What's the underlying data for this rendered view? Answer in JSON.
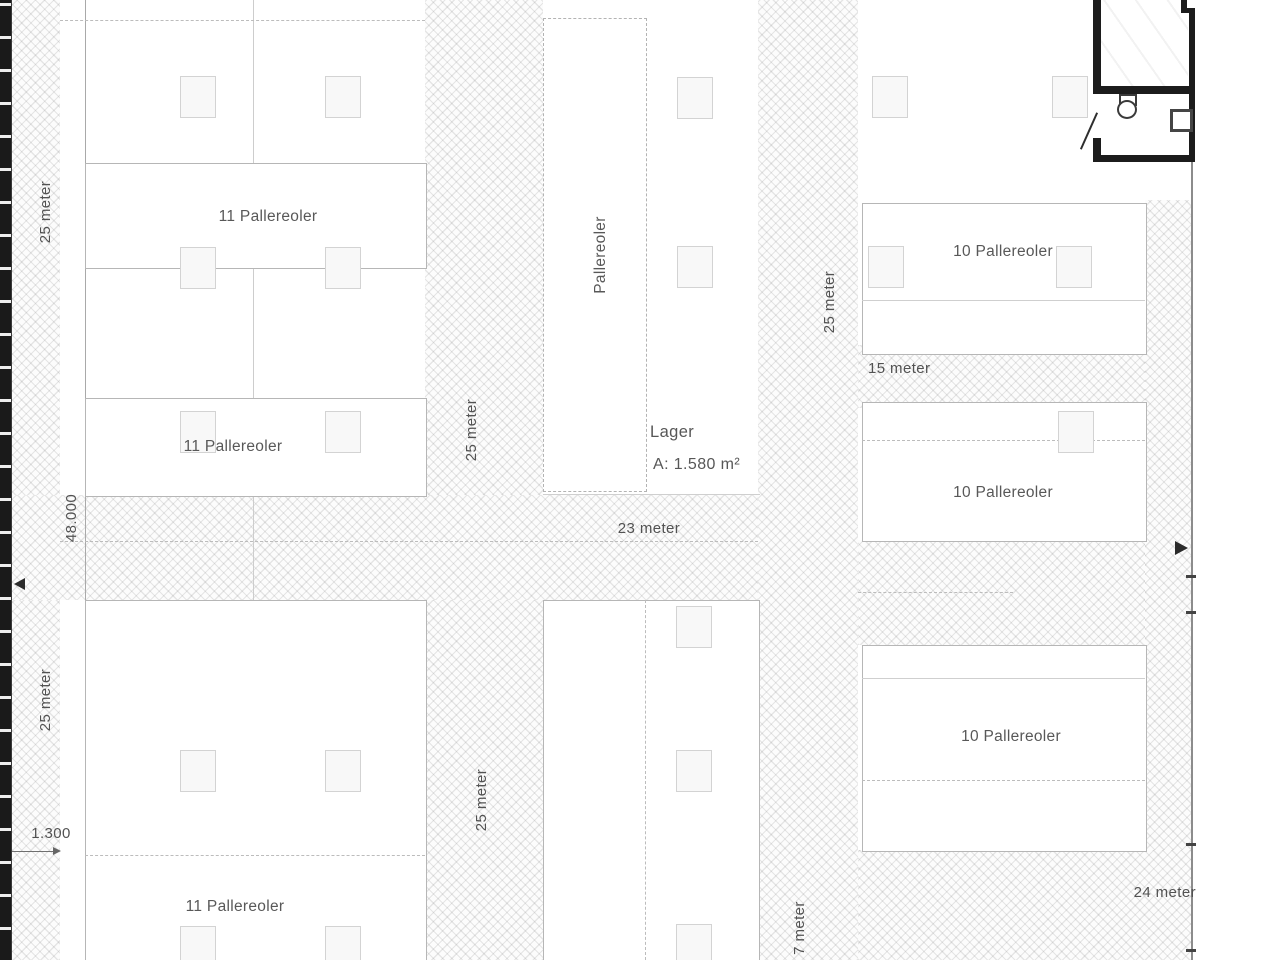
{
  "plan": {
    "rooms": {
      "lager": {
        "name": "Lager",
        "area": "A: 1.580 m²"
      }
    },
    "rack_blocks": {
      "left": [
        {
          "label": "11 Pallereoler"
        },
        {
          "label": "11 Pallereoler"
        },
        {
          "label": "11 Pallereoler"
        }
      ],
      "middle": {
        "label": "Pallereoler"
      },
      "right": [
        {
          "label": "10 Pallereoler"
        },
        {
          "label": "10 Pallereoler"
        },
        {
          "label": "10 Pallereoler"
        }
      ]
    },
    "dimensions": {
      "left_bay_top": "25 meter",
      "left_bay_bottom": "25 meter",
      "building_length": "48.000",
      "wall_offset": "1.300",
      "center_aisle_top": "25 meter",
      "center_aisle_bottom": "25 meter",
      "right_aisle": "25 meter",
      "cross_aisle": "23 meter",
      "right_bay_gap": "15 meter",
      "bottom_width": "24 meter",
      "bottom_aisle": "7 meter"
    },
    "colors": {
      "wall": "#1c1c1c",
      "line_gray": "#b6b6b6",
      "text_gray": "#585858",
      "hatch_gray": "#e4e4e4"
    }
  }
}
